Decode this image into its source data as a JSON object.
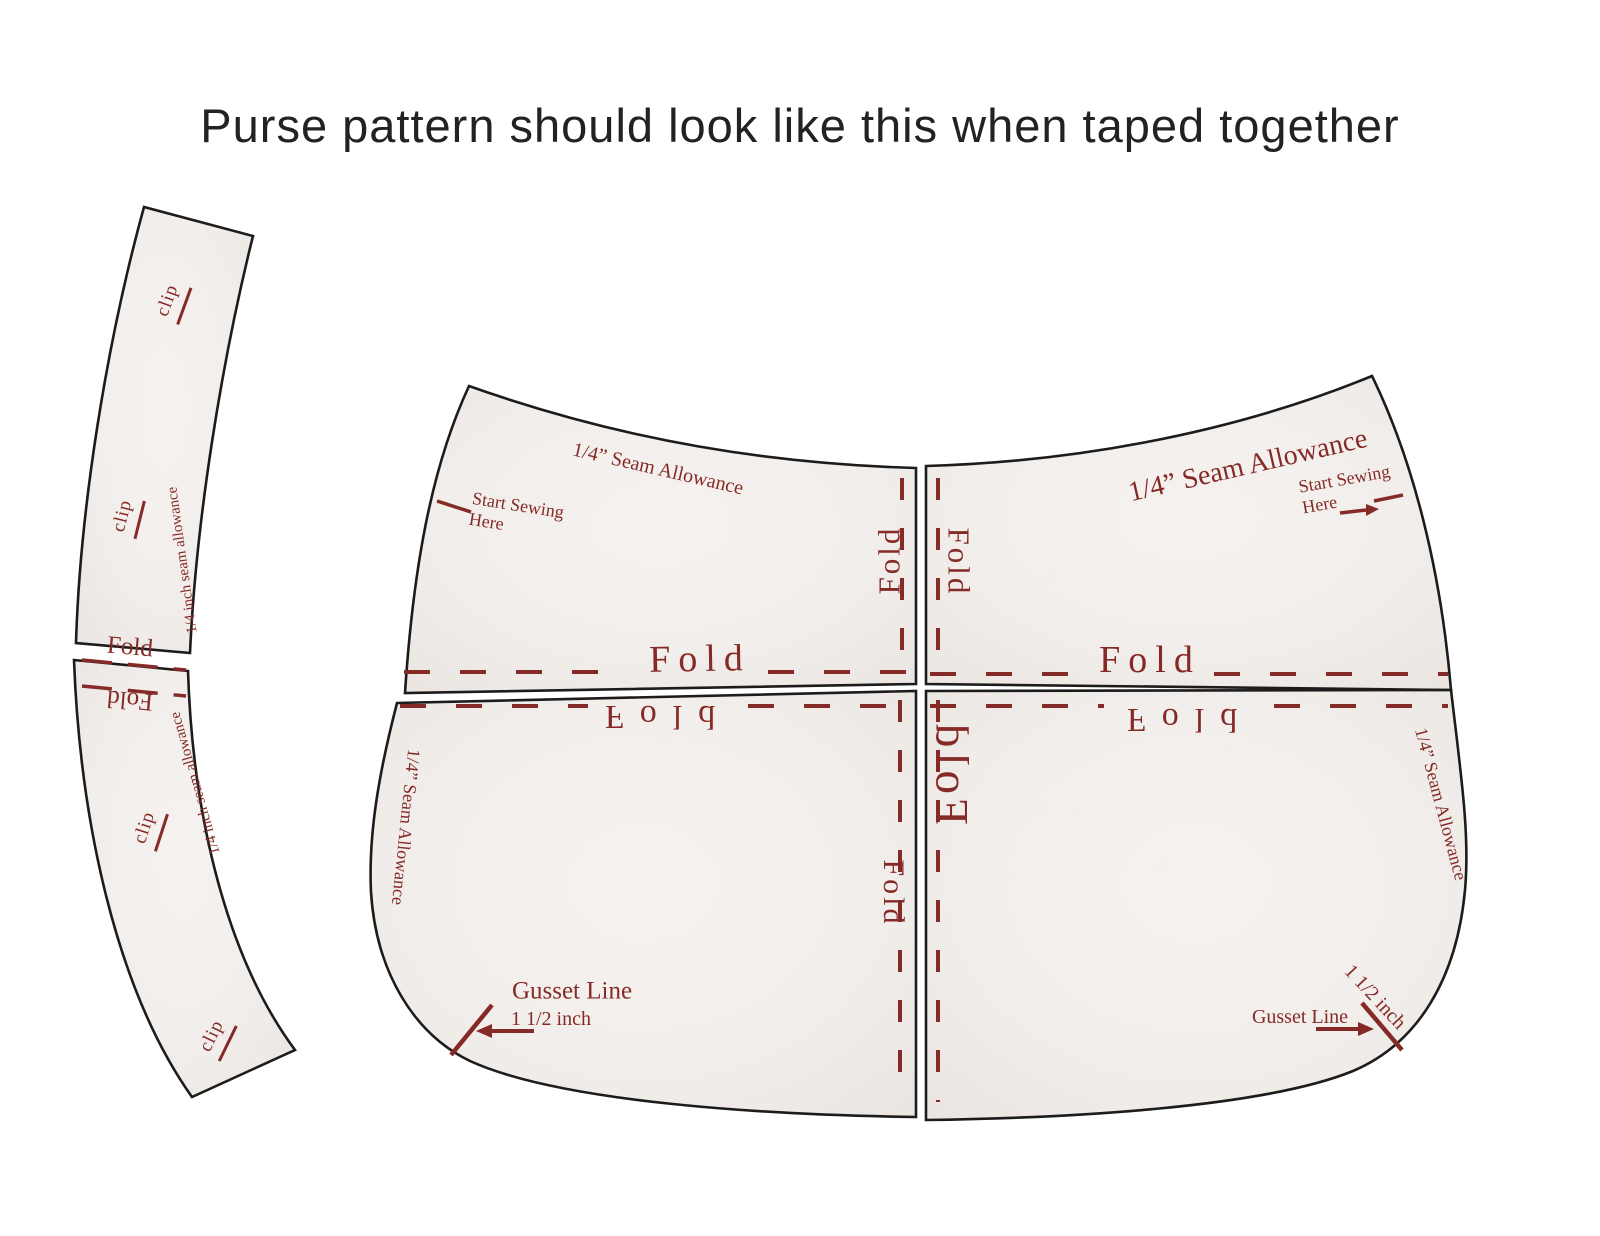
{
  "title": "Purse pattern should look like this when taped together",
  "colors": {
    "red": "#852a26",
    "ink": "#1c1c1c",
    "paper": "#f2eeeb"
  },
  "labels": {
    "fold": "Fold",
    "clip": "clip",
    "strip_seam_allowance": "1/4 inch seam allowance",
    "seam_allowance": "1/4” Seam Allowance",
    "start_sewing_line1": "Start Sewing",
    "start_sewing_line2": "Here",
    "gusset_line": "Gusset Line",
    "gusset_measurement": "1 1/2 inch"
  }
}
